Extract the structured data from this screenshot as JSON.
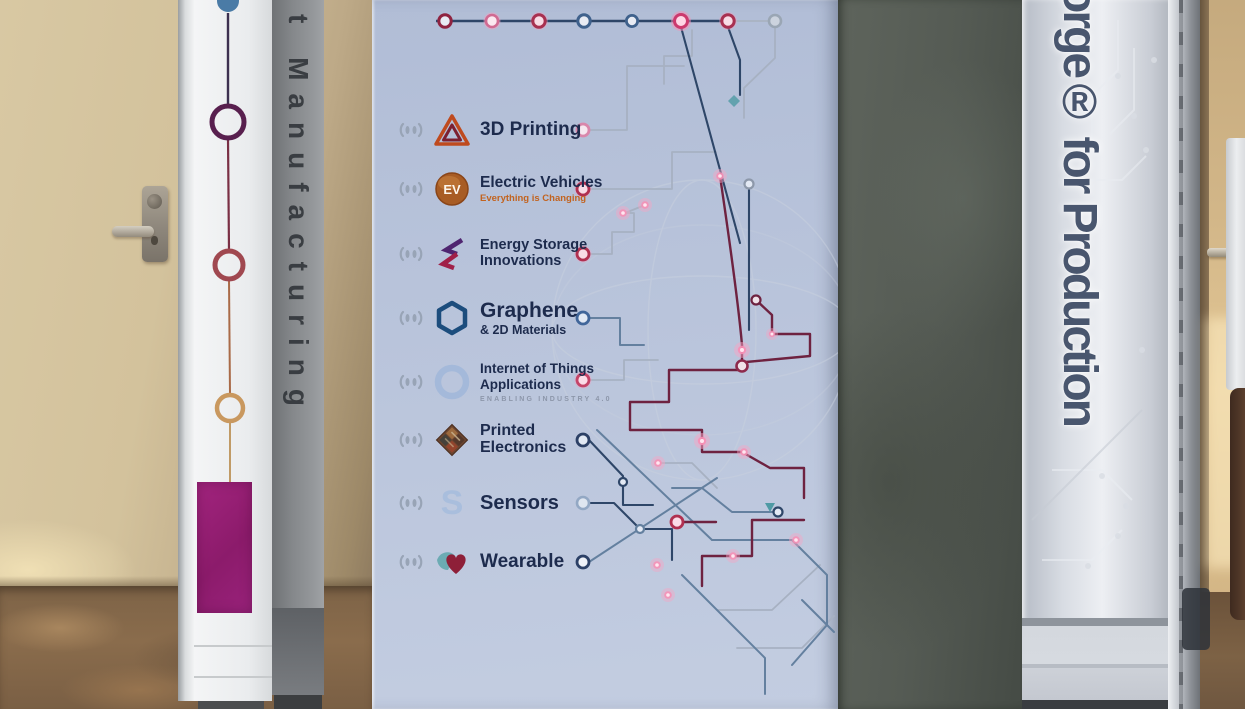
{
  "photo": {
    "setting": "Conference booth entrance: printed center banner between a graphic pillar and a concrete pillar, with doors on both sides"
  },
  "banner": {
    "topics": [
      {
        "line1": "3D Printing",
        "icon": "3d-printing-triangle-icon",
        "node_style": "pink-ring"
      },
      {
        "line1": "Electric Vehicles",
        "subtitle": "Everything is Changing",
        "icon": "ev-badge-icon",
        "node_style": "red-glow-ring"
      },
      {
        "line1": "Energy Storage",
        "line2": "Innovations",
        "icon": "energy-zigzag-icon",
        "node_style": "red-glow-ring"
      },
      {
        "line1": "Graphene",
        "line2": "& 2D Materials",
        "icon": "graphene-hexagon-icon",
        "node_style": "blue-ring"
      },
      {
        "line1": "Internet of Things",
        "line2": "Applications",
        "tagline": "ENABLING INDUSTRY 4.0",
        "icon": "iot-ring-icon",
        "node_style": "pink-glow-ring"
      },
      {
        "line1": "Printed",
        "line2": "Electronics",
        "icon": "printed-circuit-diamond-icon",
        "node_style": "navy-ring"
      },
      {
        "line1": "Sensors",
        "icon": "sensors-s-icon",
        "node_style": "faded-blue-ring"
      },
      {
        "line1": "Wearable",
        "icon": "wearable-heart-icon",
        "node_style": "navy-ring"
      }
    ],
    "ev_badge_text": "EV",
    "sensors_icon_letter": "S"
  },
  "left_pillar": {
    "vertical_text": "t Manufacturing"
  },
  "right_pillar": {
    "vertical_text": "orge® for Production"
  },
  "colors": {
    "banner_bg": "#b9c4db",
    "label_navy": "#1d2b4d",
    "ev_orange": "#b06a2e",
    "ev_subtitle_orange": "#c2631f",
    "tagline_gray": "#8d97aa",
    "magenta_panel": "#9b1f78",
    "maroon_trace": "#6e2240",
    "navy_trace": "#2e4668",
    "glow_pink": "#f78fb5",
    "concrete_gray": "#555b54",
    "wall_beige": "#d3c29c",
    "carpet_brown": "#8a6c4c"
  }
}
